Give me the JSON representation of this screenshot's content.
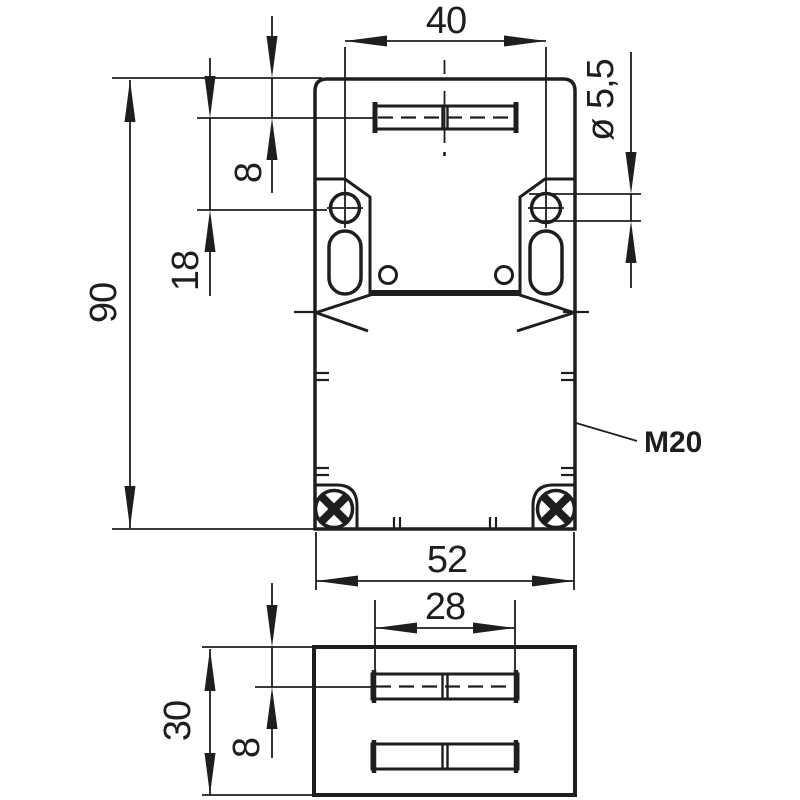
{
  "drawing": {
    "kind": "technical-dimension-drawing",
    "views": [
      "front-view",
      "side-view"
    ]
  },
  "colors": {
    "line": "#1e1e1e",
    "slot_fill": "#d9d9d9",
    "hole_fill": "#e6e6e6",
    "background": "#ffffff"
  },
  "dimensions": {
    "top_view": {
      "hole_spacing": "40",
      "slot_center_offset": "8",
      "hole_center_offset": "18",
      "body_height": "90",
      "hole_diameter": "ø 5,5",
      "body_width": "52",
      "thread_label": "M20"
    },
    "side_view": {
      "slot_width": "28",
      "body_depth": "30",
      "slot_center_offset": "8"
    }
  }
}
